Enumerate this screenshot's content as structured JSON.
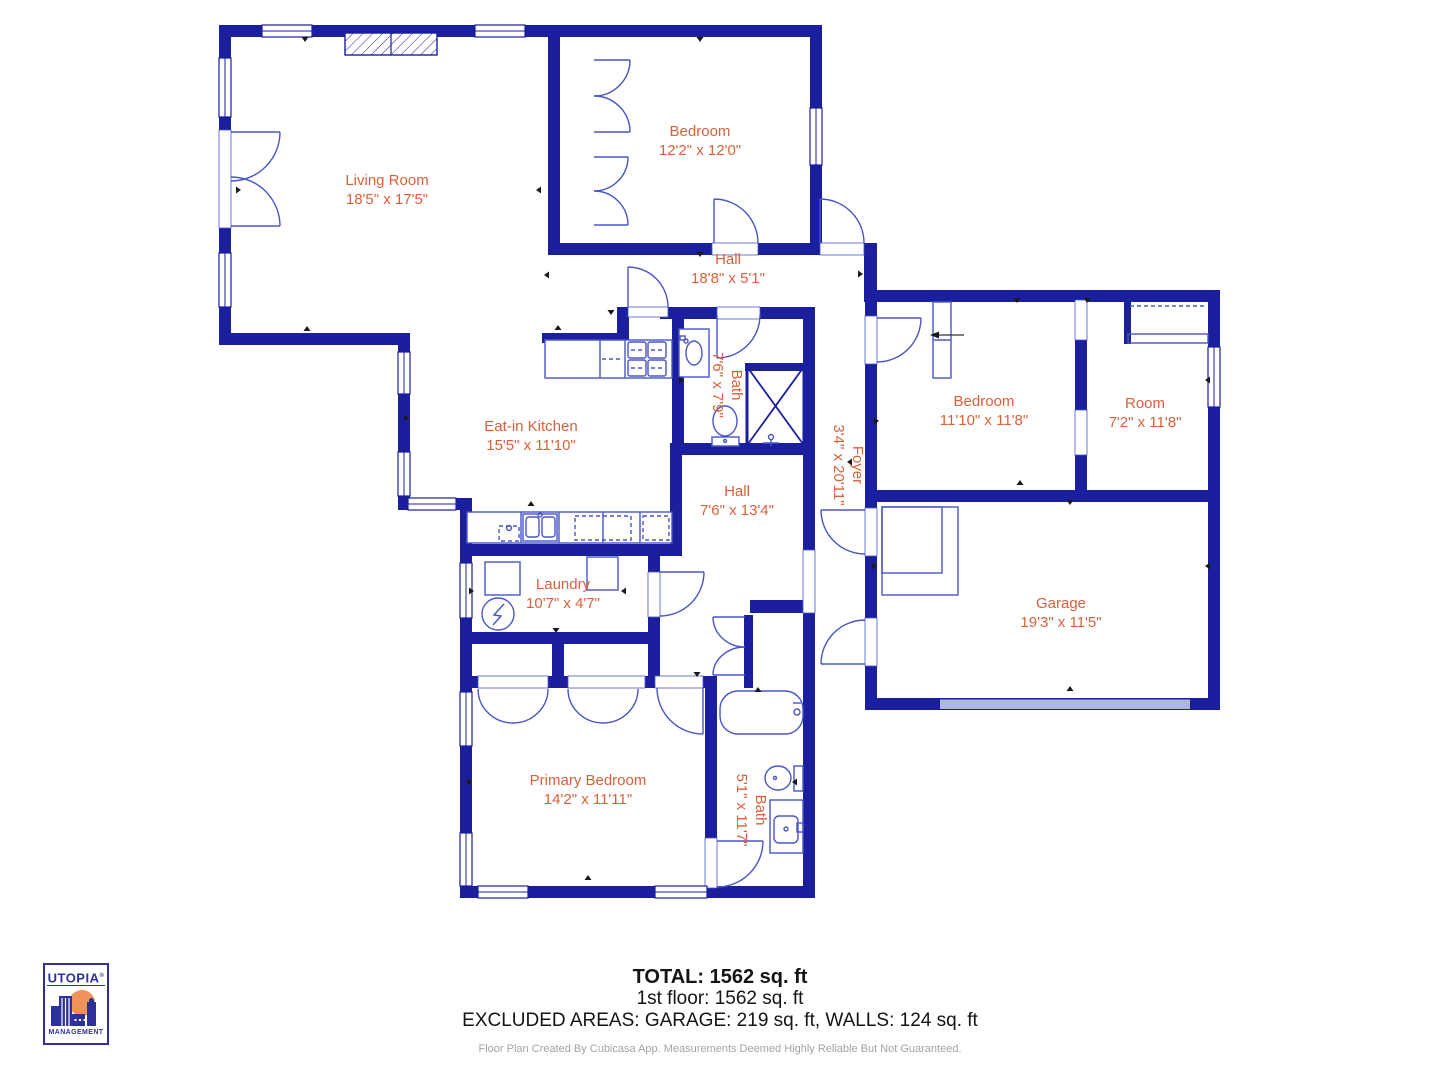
{
  "rooms": [
    {
      "id": "living-room",
      "name": "Living Room",
      "dims": "18'5\" x 17'5\""
    },
    {
      "id": "bedroom-top",
      "name": "Bedroom",
      "dims": "12'2\" x 12'0\""
    },
    {
      "id": "hall-upper",
      "name": "Hall",
      "dims": "18'8\" x 5'1\""
    },
    {
      "id": "eat-in-kitchen",
      "name": "Eat-in Kitchen",
      "dims": "15'5\" x 11'10\""
    },
    {
      "id": "bath-middle",
      "name": "Bath",
      "dims": "7'6\" x 7'9\""
    },
    {
      "id": "hall-lower",
      "name": "Hall",
      "dims": "7'6\" x 13'4\""
    },
    {
      "id": "foyer",
      "name": "Foyer",
      "dims": "3'4\" x 20'11\""
    },
    {
      "id": "bedroom-right",
      "name": "Bedroom",
      "dims": "11'10\" x 11'8\""
    },
    {
      "id": "room",
      "name": "Room",
      "dims": "7'2\" x 11'8\""
    },
    {
      "id": "garage",
      "name": "Garage",
      "dims": "19'3\" x 11'5\""
    },
    {
      "id": "laundry",
      "name": "Laundry",
      "dims": "10'7\" x 4'7\""
    },
    {
      "id": "primary-bedroom",
      "name": "Primary Bedroom",
      "dims": "14'2\" x 11'11\""
    },
    {
      "id": "bath-bottom",
      "name": "Bath",
      "dims": "5'1\" x 11'7\""
    }
  ],
  "title_block": {
    "total": "TOTAL: 1562 sq. ft",
    "floor": "1st floor: 1562 sq. ft",
    "excluded": "EXCLUDED AREAS: GARAGE: 219 sq. ft, WALLS: 124 sq. ft",
    "disclaimer": "Floor Plan Created By Cubicasa App. Measurements Deemed Highly Reliable But Not Guaranteed."
  },
  "logo": {
    "brand": "UTOPIA",
    "registered": "®",
    "subtitle": "MANAGEMENT"
  },
  "colors": {
    "wall": "#1b1f9e",
    "fixture": "#4856c5",
    "label": "#d9603b",
    "garage_door": "#aeb6e8",
    "text": "#141414",
    "disclaimer": "#a3a3a3",
    "logo_navy": "#2f319b",
    "logo_orange": "#f0925c"
  }
}
